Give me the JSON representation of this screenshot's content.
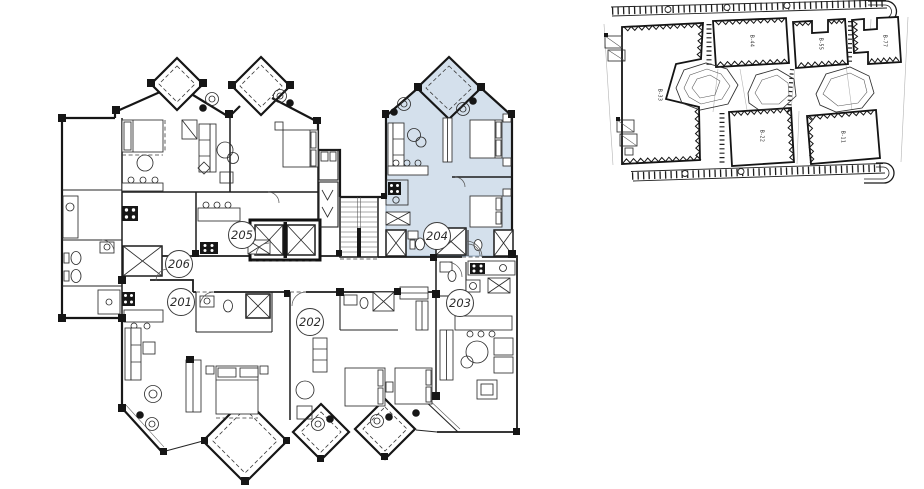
{
  "floor_plan": {
    "highlight_color": "#d4e0ec",
    "highlighted_unit": "204",
    "units": [
      {
        "number": "201"
      },
      {
        "number": "202"
      },
      {
        "number": "203"
      },
      {
        "number": "204"
      },
      {
        "number": "205"
      },
      {
        "number": "206"
      }
    ]
  },
  "site_plan": {
    "highlight_color": "#aecfec",
    "highlighted_block": "B-55",
    "blocks": [
      {
        "label": "B-44"
      },
      {
        "label": "B-55"
      },
      {
        "label": "B-77"
      },
      {
        "label": "B-33"
      },
      {
        "label": "B-22"
      },
      {
        "label": "B-11"
      }
    ]
  }
}
